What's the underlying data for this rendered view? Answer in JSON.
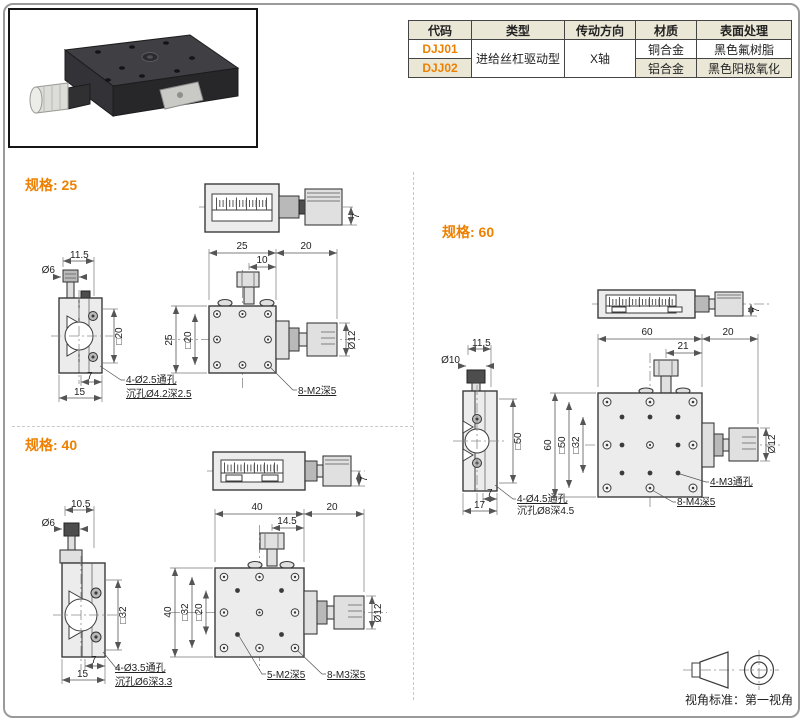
{
  "page": {
    "accent_color": "#ed8000",
    "photo": "black-linear-translation-stage-product-photo"
  },
  "table": {
    "headers": [
      "代码",
      "类型",
      "传动方向",
      "材质",
      "表面处理"
    ],
    "type_value": "进给丝杠驱动型",
    "direction_value": "X轴",
    "rows": [
      {
        "code": "DJJ01",
        "material": "铜合金",
        "finish": "黑色氟树脂"
      },
      {
        "code": "DJJ02",
        "material": "铝合金",
        "finish": "黑色阳极氧化"
      }
    ]
  },
  "specs": {
    "s25": {
      "label": "规格: 25",
      "top_view": {
        "stem": "7"
      },
      "side_view": {
        "top_offset": "11.5",
        "knob_dia": "Ø6",
        "square": "□20",
        "step": "7",
        "base_width": "15",
        "note1": "4-Ø2.5通孔",
        "note2": "沉孔Ø4.2深2.5"
      },
      "front_view": {
        "width": "25",
        "knob_len": "20",
        "clamp_offset": "10",
        "height": "25",
        "square_outer": "□20",
        "knob_dia": "Ø12",
        "note1": "8-M2深5"
      }
    },
    "s40": {
      "label": "规格: 40",
      "top_view": {
        "stem": "7"
      },
      "side_view": {
        "top_offset": "10.5",
        "knob_dia": "Ø6",
        "square": "□32",
        "step": "7",
        "base_width": "15",
        "note1": "4-Ø3.5通孔",
        "note2": "沉孔Ø6深3.3"
      },
      "front_view": {
        "width": "40",
        "knob_len": "20",
        "clamp_offset": "14.5",
        "height": "40",
        "square_outer": "□32",
        "square_inner": "□20",
        "knob_dia": "Ø12",
        "note1": "5-M2深5",
        "note2": "8-M3深5"
      }
    },
    "s60": {
      "label": "规格: 60",
      "top_view": {
        "stem": "7"
      },
      "side_view": {
        "top_offset": "11.5",
        "knob_dia": "Ø10",
        "square": "□50",
        "step": "7",
        "base_width": "17",
        "note1": "4-Ø4.5通孔",
        "note2": "沉孔Ø8深4.5"
      },
      "front_view": {
        "width": "60",
        "knob_len": "20",
        "clamp_offset": "21",
        "height": "60",
        "square_outer": "□50",
        "square_inner": "□32",
        "knob_dia": "Ø12",
        "note1": "4-M3通孔",
        "note2": "8-M4深5"
      }
    }
  },
  "footer": {
    "view_standard": "视角标准：第一视角"
  }
}
